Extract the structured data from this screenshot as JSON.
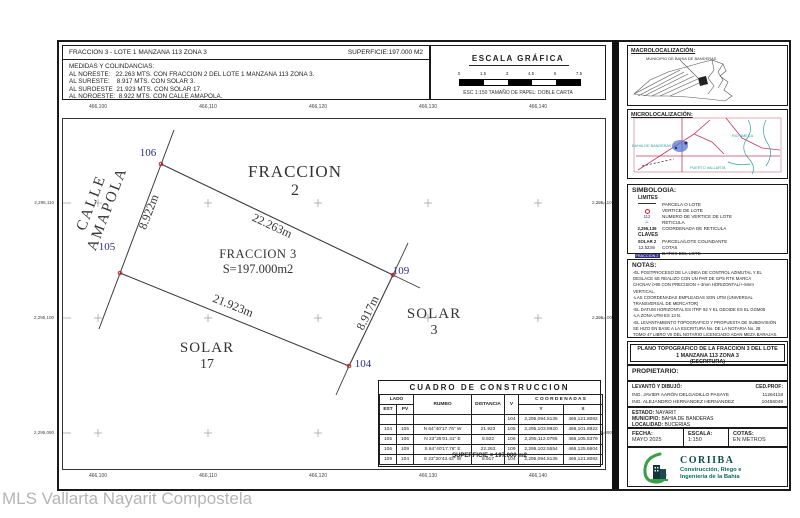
{
  "watermark": "MLS Vallarta Nayarit Compostela",
  "header": {
    "title": "FRACCION 3 - LOTE 1 MANZANA 113 ZONA 3",
    "superficie": "SUPERFICIE:197.000 M2",
    "medidas_title": "MEDIDAS Y COLINDANCIAS:",
    "medidas": [
      "AL NORESTE:   22.263 MTS. CON FRACCION 2 DEL LOTE 1 MANZANA 113 ZONA 3.",
      "AL SURESTE:    8.917 MTS. CON SOLAR 3.",
      "AL SUROESTE  21.923 MTS. CON SOLAR 17.",
      "AL NOROESTE:  8.922 MTS. CON CALLE AMAPOLA."
    ]
  },
  "scale_bar": {
    "title": "ESCALA GRÁFICA",
    "ticks": [
      "0",
      "1.5",
      "3",
      "4.5",
      "6",
      "7.5"
    ],
    "caption": "ESC 1:150 TAMAÑO DE PAPEL: DOBLE CARTA"
  },
  "grid": {
    "eastings": [
      "466,100",
      "466,110",
      "466,120",
      "466,130",
      "466,140"
    ],
    "northings": [
      "2,295,110",
      "2,295,100",
      "2,295,090"
    ]
  },
  "map": {
    "street": "CALLE AMAPOLA",
    "labels": {
      "fraccion2_line1": "FRACCION",
      "fraccion2_line2": "2",
      "fraccion3_line1": "FRACCION 3",
      "fraccion3_line2": "S=197.000m2",
      "solar3_line1": "SOLAR",
      "solar3_line2": "3",
      "solar17_line1": "SOLAR",
      "solar17_line2": "17"
    },
    "vertex_labels": [
      "106",
      "105",
      "109",
      "104"
    ],
    "dims": {
      "ne": "22.263m",
      "nw": "8.922m",
      "sw": "21.923m",
      "se": "8.917m"
    }
  },
  "cuadro": {
    "title": "CUADRO DE CONSTRUCCION",
    "headers": {
      "lado": "LADO",
      "est": "EST",
      "pv": "PV",
      "rumbo": "RUMBO",
      "distancia": "DISTANCIA",
      "v": "V",
      "coordenadas": "C O O R D E N A D A S",
      "y": "Y",
      "x": "X"
    },
    "rows": [
      [
        "",
        "",
        "",
        "",
        "104",
        "2,295,094.5135",
        "466,121.8082"
      ],
      [
        "104",
        "105",
        "N 64°40'17.76\" W",
        "21.923",
        "105",
        "2,295,103.8920",
        "466,101.8922"
      ],
      [
        "105",
        "106",
        "N 23°25'01.41\" E",
        "8.922",
        "106",
        "2,295,112.0795",
        "466,105.5379"
      ],
      [
        "106",
        "109",
        "S 64°40'17.76\" E",
        "22.263",
        "109",
        "2,295,102.5554",
        "466,125.6604"
      ],
      [
        "109",
        "104",
        "S 23°20'43.43\" W",
        "8.917",
        "104",
        "2,295,094.5135",
        "466,121.8082"
      ]
    ],
    "superficie": "SUPERFICIE = 197.000 m2"
  },
  "panel": {
    "macro": {
      "title": "MACROLOCALIZACIÓN:",
      "caption": "MUNICIPIO DE BAHIA DE BANDERAS"
    },
    "micro": {
      "title": "MICROLOCALIZACIÓN:",
      "labels": [
        {
          "t": "RIO AMECA",
          "x": 104,
          "y": 24
        },
        {
          "t": "PUERTO VALLARTA",
          "x": 62,
          "y": 56
        },
        {
          "t": "BAHIA DE BANDERAS",
          "x": 4,
          "y": 34
        }
      ]
    },
    "simbologia": {
      "title": "SIMBOLOGIA:",
      "limites": "LIMITES",
      "claves": "CLAVES",
      "items": [
        {
          "s": "line",
          "label": "PARCELA O LOTE"
        },
        {
          "s": "circle",
          "label": "VERTICE DE LOTE"
        },
        {
          "s": "txt",
          "sv": "112",
          "label": "NUMERO DE VERTICE DE LOTE"
        },
        {
          "s": "cross",
          "label": "RETICULA"
        },
        {
          "s": "txtb",
          "sv": "2,295,136",
          "label": "COORDENADA DE RETICULA"
        }
      ],
      "items2": [
        {
          "s": "txtb",
          "sv": "SOLAR 2",
          "label": "PARCELA/LOTE COLINDANTE"
        },
        {
          "s": "txt",
          "sv": "12.523m",
          "label": "COTAS"
        },
        {
          "s": "dark",
          "sv": "FRACCION 2",
          "label": "DATOS DEL LOTE"
        }
      ]
    },
    "notas": {
      "title": "NOTAS:",
      "lines": [
        "-EL POSTPROCESO DE LA LINEA DE CONTROL AZIMUTAL Y EL",
        "DESLACE SE REALIZO CON UN PAR DE GPS RTK MARCA",
        "CHCNAV i>90 CON PRECISION +-3mm HORIZONTAL/+-5mm",
        "VERTICAL.",
        "-LAS COORDENADAS EMPLEADAS SON UTM (UNIVERSAL",
        "TRANSVERSAL DE MERCATOR)",
        "-EL DATUM HORIZONTAL ES ITRF 92 Y EL GEOIDE ES EL GGM05",
        "-LA ZONA UTM ES 13 N.",
        "-EL LEVANTAMIENTO TOPOGRAFICO Y PROPUESTA DE SUBDIVISIÓN",
        "SE HIZO EN BASE A LA ESCRITURA No. DE LA NOTARIA No. 28",
        "TOMO 47 LIBRO VII DEL NOTARIO LICENCIADO ADAN MEZA BARAJAS."
      ]
    },
    "plano": {
      "line1": "PLANO TOPOGRAFICO DE LA FRACCION 3 DEL LOTE",
      "line2": "1 MANZANA 113 ZONA 3",
      "line3": "(ESCRITURA)"
    },
    "propietario": "PROPIETARIO:",
    "levanto": {
      "label": "LEVANTÓ Y DIBUJÓ:",
      "ced": "CED.PROF:",
      "rows": [
        {
          "name": "ING. JAVIER AARÓN DELGADILLO PASAYE",
          "ced": "11264118"
        },
        {
          "name": "ING. ALEJANDRO HERNANDEZ HERNANDEZ",
          "ced": "10456049"
        }
      ]
    },
    "ubicacion": {
      "estado_label": "ESTADO:",
      "estado": "NAYARIT",
      "municipio_label": "MUNICIPIO:",
      "municipio": "BAHIA DE BANDERAS",
      "localidad_label": "LOCALIDAD:",
      "localidad": "BUCERIAS"
    },
    "meta": {
      "fecha_label": "FECHA:",
      "fecha": "MAYO 2025",
      "escala_label": "ESCALA:",
      "escala": "1:150",
      "cotas_label": "COTAS:",
      "cotas": "EN METROS"
    },
    "logo": {
      "name": "CORIIBA",
      "tagline1": "Construcción, Riego e",
      "tagline2": "Ingeniería de la Bahía"
    }
  },
  "colors": {
    "vertex_marker": "#cc2222",
    "vertex_label": "#2d2d86",
    "roads": "#c23b63",
    "water": "#2e9e9e",
    "logo_teal": "#0e6b5e",
    "logo_green": "#3aa048",
    "watermark": "#b5b5b5"
  }
}
